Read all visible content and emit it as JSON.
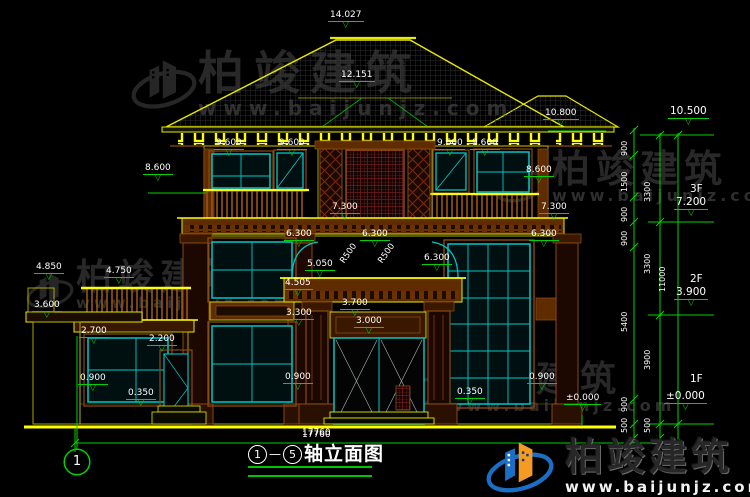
{
  "title": {
    "from": "1",
    "dash": "—",
    "to": "5",
    "text": "轴立面图"
  },
  "axis": {
    "bubble": "1"
  },
  "bottom_dim_total": "17760",
  "watermarks": {
    "brand": "柏竣建筑",
    "url": "www.baijunjz.com"
  },
  "colors": {
    "dim_green": "#00d400",
    "line_yellow": "#e8e800",
    "bright_yellow": "#ffff00",
    "frame_cyan": "#00c8c8",
    "wood_brown": "#8a4a10",
    "dark_wood": "#5f2c00",
    "lattice_red": "#6e1c1c",
    "text_white": "#ffffff",
    "logo_blue": "#1a6fc4",
    "logo_orange": "#f59b23"
  },
  "labels": [
    {
      "t": "14.027",
      "x": 328,
      "y": 11
    },
    {
      "t": "12.151",
      "x": 339,
      "y": 71
    },
    {
      "t": "10.800",
      "x": 543,
      "y": 109
    },
    {
      "t": "10.500",
      "x": 668,
      "y": 106,
      "cls": "biglvl"
    },
    {
      "t": "9.600",
      "x": 214,
      "y": 139
    },
    {
      "t": "9.600",
      "x": 277,
      "y": 139
    },
    {
      "t": "9.600",
      "x": 435,
      "y": 139
    },
    {
      "t": "9.600",
      "x": 470,
      "y": 139
    },
    {
      "t": "8.600",
      "x": 143,
      "y": 164
    },
    {
      "t": "8.600",
      "x": 524,
      "y": 166
    },
    {
      "t": "7.300",
      "x": 330,
      "y": 203
    },
    {
      "t": "7.300",
      "x": 539,
      "y": 203
    },
    {
      "t": "6.300",
      "x": 284,
      "y": 230
    },
    {
      "t": "6.300",
      "x": 360,
      "y": 230
    },
    {
      "t": "6.300",
      "x": 529,
      "y": 230
    },
    {
      "t": "6.300",
      "x": 422,
      "y": 254
    },
    {
      "t": "5.050",
      "x": 305,
      "y": 260
    },
    {
      "t": "4.850",
      "x": 34,
      "y": 263
    },
    {
      "t": "4.750",
      "x": 104,
      "y": 267
    },
    {
      "t": "4.505",
      "x": 283,
      "y": 279
    },
    {
      "t": "3.700",
      "x": 340,
      "y": 299
    },
    {
      "t": "3.600",
      "x": 32,
      "y": 301
    },
    {
      "t": "3.300",
      "x": 284,
      "y": 309
    },
    {
      "t": "3.000",
      "x": 354,
      "y": 317
    },
    {
      "t": "2.700",
      "x": 79,
      "y": 327
    },
    {
      "t": "2.200",
      "x": 147,
      "y": 335
    },
    {
      "t": "0.900",
      "x": 78,
      "y": 374
    },
    {
      "t": "0.900",
      "x": 283,
      "y": 373
    },
    {
      "t": "0.900",
      "x": 527,
      "y": 373
    },
    {
      "t": "0.350",
      "x": 126,
      "y": 389
    },
    {
      "t": "0.350",
      "x": 455,
      "y": 388
    },
    {
      "t": "±0.000",
      "x": 564,
      "y": 394
    },
    {
      "t": "R500",
      "x": 338,
      "y": 262,
      "cls": "r500"
    },
    {
      "t": "R500",
      "x": 376,
      "y": 262,
      "cls": "r500"
    },
    {
      "t": "17760",
      "x": 300,
      "y": 429,
      "cls": "lab"
    },
    {
      "t": "900",
      "x": 621,
      "y": 156,
      "cls": "rot"
    },
    {
      "t": "1500",
      "x": 621,
      "y": 192,
      "cls": "rot"
    },
    {
      "t": "900",
      "x": 621,
      "y": 222,
      "cls": "rot"
    },
    {
      "t": "900",
      "x": 621,
      "y": 246,
      "cls": "rot"
    },
    {
      "t": "5400",
      "x": 621,
      "y": 332,
      "cls": "rot"
    },
    {
      "t": "900",
      "x": 621,
      "y": 412,
      "cls": "rot"
    },
    {
      "t": "500",
      "x": 621,
      "y": 433,
      "cls": "rot"
    },
    {
      "t": "3300",
      "x": 644,
      "y": 202,
      "cls": "rot"
    },
    {
      "t": "3300",
      "x": 644,
      "y": 274,
      "cls": "rot"
    },
    {
      "t": "3900",
      "x": 644,
      "y": 370,
      "cls": "rot"
    },
    {
      "t": "500",
      "x": 644,
      "y": 433,
      "cls": "rot"
    },
    {
      "t": "11000",
      "x": 659,
      "y": 292,
      "cls": "rot"
    },
    {
      "t": "3F",
      "x": 688,
      "y": 184,
      "cls": "big"
    },
    {
      "t": "7.200",
      "x": 674,
      "y": 197,
      "cls": "biglvl"
    },
    {
      "t": "2F",
      "x": 688,
      "y": 274,
      "cls": "big"
    },
    {
      "t": "3.900",
      "x": 674,
      "y": 287,
      "cls": "biglvl"
    },
    {
      "t": "1F",
      "x": 688,
      "y": 374,
      "cls": "big"
    },
    {
      "t": "±0.000",
      "x": 664,
      "y": 391,
      "cls": "biglvl"
    }
  ]
}
